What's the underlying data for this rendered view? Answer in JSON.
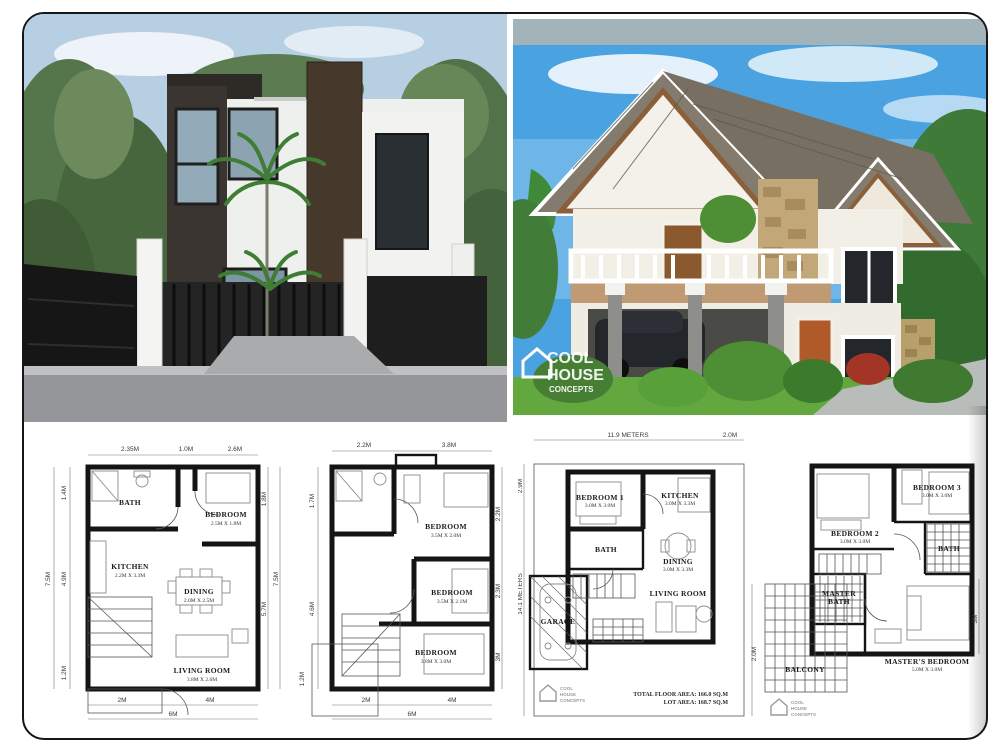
{
  "watermark": {
    "line1": "COOL",
    "line2": "HOUSE",
    "line3": "CONCEPTS"
  },
  "plans": {
    "plan1": {
      "rooms": {
        "bath": {
          "name": "BATH"
        },
        "bedroom": {
          "name": "BEDROOM",
          "dim": "2.5M X 1.8M"
        },
        "kitchen": {
          "name": "KITCHEN",
          "dim": "2.2M X 3.3M"
        },
        "dining": {
          "name": "DINING",
          "dim": "2.0M X 2.5M"
        },
        "living": {
          "name": "LIVING ROOM",
          "dim": "3.8M X 2.6M"
        }
      },
      "dims": {
        "top1": "2.35M",
        "top2": "1.0M",
        "top3": "2.6M",
        "left1": "1.4M",
        "left2": "7.5M",
        "left3": "4.9M",
        "left4": "1.2M",
        "right1": "1.8M",
        "right2": "5.7M",
        "right3": "7.5M",
        "bottom1": "2M",
        "bottom2": "4M",
        "bottom3": "6M"
      }
    },
    "plan2": {
      "rooms": {
        "bedroom1": {
          "name": "BEDROOM",
          "dim": "3.5M X 2.0M"
        },
        "bedroom2": {
          "name": "BEDROOM",
          "dim": "3.5M X 2.1M"
        },
        "bedroom3": {
          "name": "BEDROOM",
          "dim": "3.8M X 3.0M"
        }
      },
      "dims": {
        "top1": "2.2M",
        "top2": "3.8M",
        "left1": "1.7M",
        "left2": "4.6M",
        "left3": "1.2M",
        "right1": "2.2M",
        "right2": "2.3M",
        "right3": "3M",
        "bottom1": "2M",
        "bottom2": "4M",
        "bottom3": "6M"
      }
    },
    "plan3": {
      "rooms": {
        "bedroom1": {
          "name": "BEDROOM 1",
          "dim": "3.0M X 3.0M"
        },
        "kitchen": {
          "name": "KITCHEN",
          "dim": "3.0M X 3.3M"
        },
        "bath": {
          "name": "BATH"
        },
        "dining": {
          "name": "DINING",
          "dim": "3.0M X 3.3M"
        },
        "living": {
          "name": "LIVING ROOM"
        },
        "garage": {
          "name": "GARAGE"
        }
      },
      "dims": {
        "top1": "11.9 METERS",
        "top2": "2.0M",
        "left1": "2.9M",
        "left2": "14.1 METERS",
        "right1": "2.0M"
      },
      "notes": {
        "total": "TOTAL FLOOR AREA: 166.0 SQ.M",
        "lot": "LOT AREA: 168.7 SQ.M"
      }
    },
    "plan4": {
      "rooms": {
        "bedroom2": {
          "name": "BEDROOM 2",
          "dim": "3.0M X 3.0M"
        },
        "bedroom3": {
          "name": "BEDROOM 3",
          "dim": "3.0M X 3.0M"
        },
        "bath": {
          "name": "BATH"
        },
        "masterbath1": "MASTER",
        "masterbath2": "BATH",
        "master": {
          "name": "MASTER'S BEDROOM",
          "dim": "5.0M X 3.0M"
        },
        "balcony": {
          "name": "BALCONY"
        }
      },
      "dims": {
        "right1": "3M"
      }
    }
  }
}
